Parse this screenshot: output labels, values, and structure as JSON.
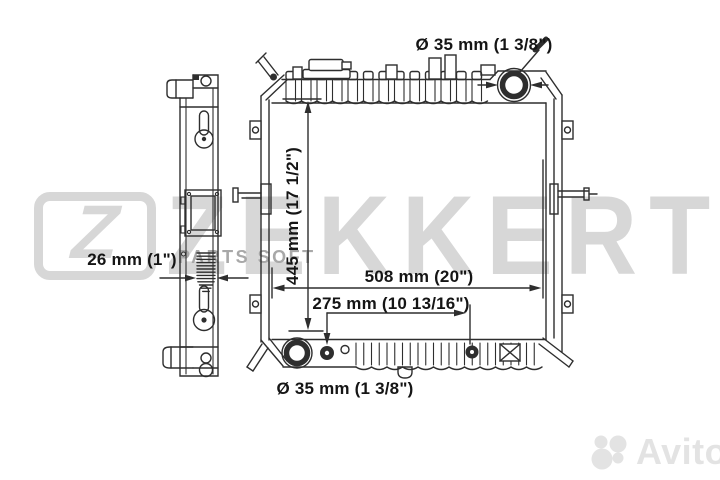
{
  "labels": {
    "top_diameter": "Ø 35 mm (1 3/8\")",
    "core_height": "445 mm (17 1/2\")",
    "overall_width": "508 mm (20\")",
    "port_spacing": "275 mm (10 13/16\")",
    "core_thickness": "26 mm (1\")",
    "bottom_diameter": "Ø 35 mm (1 3/8\")"
  },
  "watermarks": {
    "brand_initial": "Z",
    "brand": "ZEKKERT",
    "supplier": "PARTS SOFT",
    "marketplace": "Avito"
  },
  "colors": {
    "line": "#2e2e2e",
    "watermark_light": "#d7d7d7",
    "watermark_mid": "#a8a8a8",
    "watermark_faint": "#e3e3e3",
    "background": "#ffffff"
  }
}
